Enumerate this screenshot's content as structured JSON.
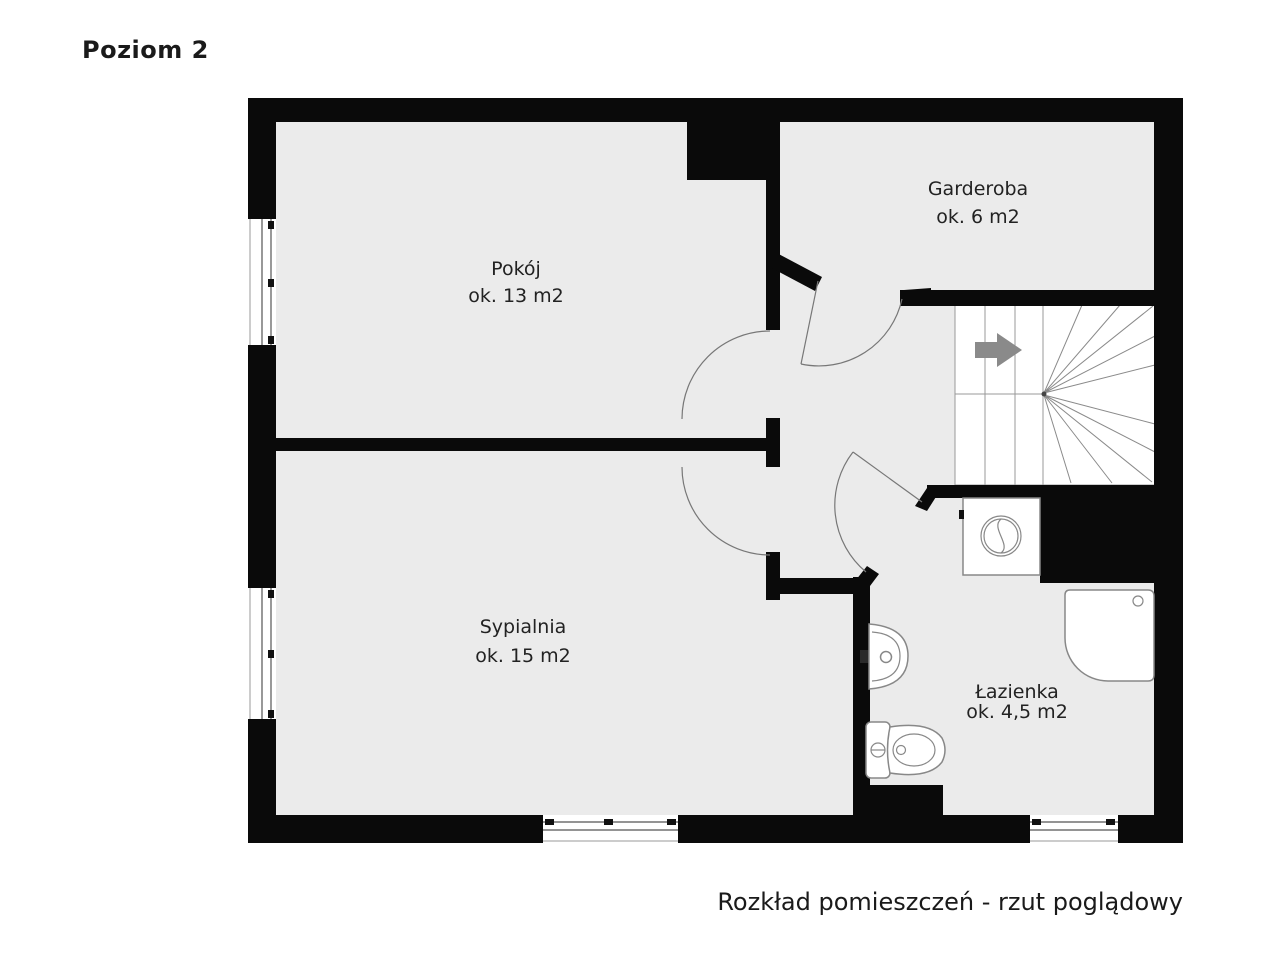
{
  "page": {
    "title": "Poziom 2",
    "caption": "Rozkład pomieszczeń - rzut poglądowy"
  },
  "rooms": [
    {
      "id": "pokoj",
      "name": "Pokój",
      "area": "ok. 13 m2"
    },
    {
      "id": "garderoba",
      "name": "Garderoba",
      "area": "ok. 6 m2"
    },
    {
      "id": "sypialnia",
      "name": "Sypialnia",
      "area": "ok. 15 m2"
    },
    {
      "id": "lazienka",
      "name": "Łazienka",
      "area": "ok. 4,5 m2"
    }
  ],
  "icons": {
    "direction_arrow": "right-arrow",
    "fixtures": [
      "staircase",
      "washing-machine",
      "shower",
      "sink",
      "toilet",
      "window",
      "door-swing"
    ]
  },
  "colors": {
    "floor": "#ebebeb",
    "wall": "#0a0a0a",
    "text": "#1a1a1a",
    "arrow": "#8a8a8a",
    "stair_line": "#999999",
    "fixture_stroke": "#888888",
    "door": "#777777"
  }
}
